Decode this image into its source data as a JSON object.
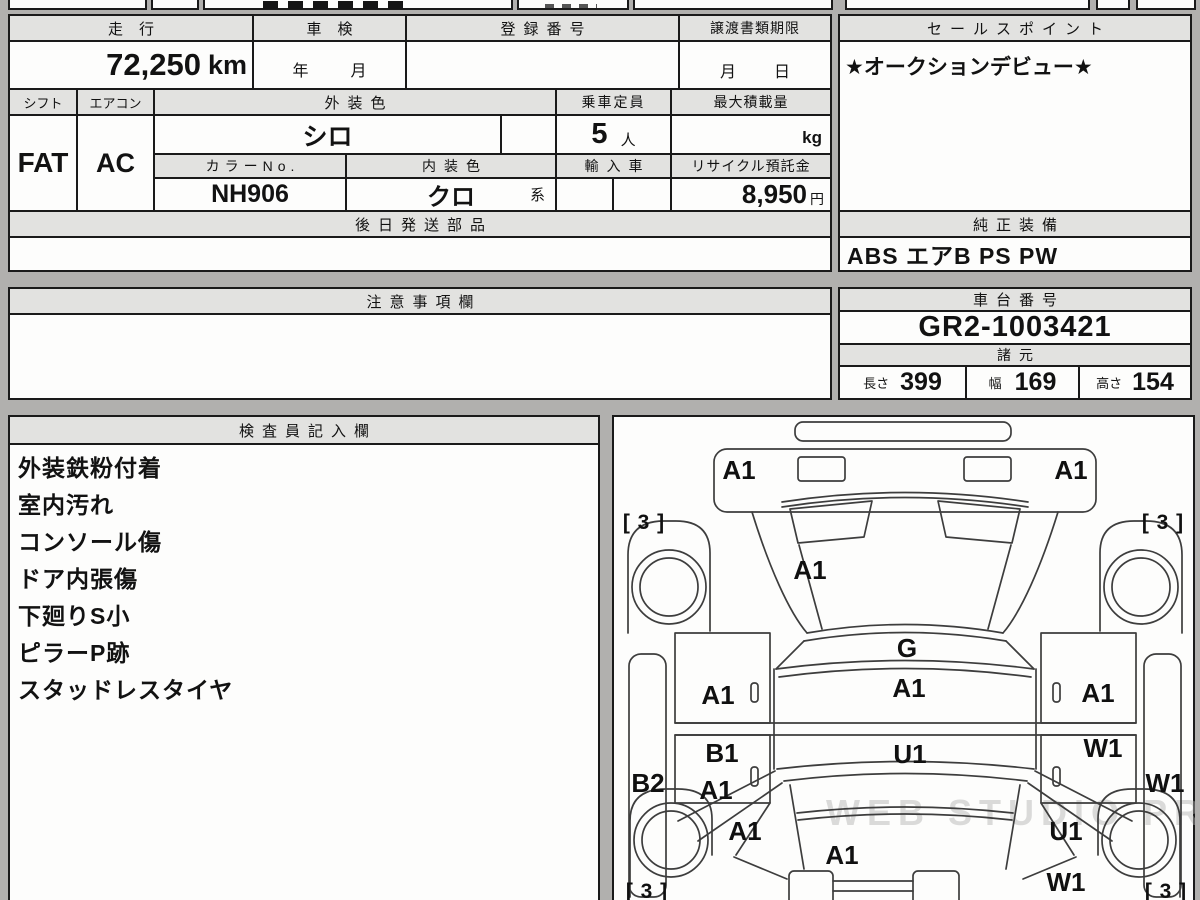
{
  "top": {
    "mileage_label": "走行",
    "mileage_value": "72,250",
    "mileage_unit": "km",
    "shaken_label": "車検",
    "shaken_year": "年",
    "shaken_month": "月",
    "regno_label": "登録番号",
    "transfer_label": "譲渡書類期限",
    "transfer_month": "月",
    "transfer_day": "日"
  },
  "sales": {
    "label": "セールスポイント",
    "value": "★オークションデビュー★"
  },
  "spec": {
    "shift_label": "シフト",
    "shift_value": "FAT",
    "aircon_label": "エアコン",
    "aircon_value": "AC",
    "ext_color_label": "外装色",
    "ext_color_value": "シロ",
    "capacity_label": "乗車定員",
    "capacity_value": "5",
    "capacity_unit": "人",
    "max_load_label": "最大積載量",
    "max_load_unit": "kg",
    "color_no_label": "カラーNo.",
    "color_no_value": "NH906",
    "int_color_label": "内装色",
    "int_color_value": "クロ",
    "int_color_suffix": "系",
    "import_label": "輸入車",
    "recycle_label": "リサイクル預託金",
    "recycle_value": "8,950",
    "recycle_unit": "円"
  },
  "parts": {
    "label": "後日発送部品"
  },
  "equipment": {
    "label": "純正装備",
    "value": "ABS エアB PS PW"
  },
  "notes": {
    "label": "注意事項欄"
  },
  "chassis": {
    "label": "車台番号",
    "value": "GR2-1003421"
  },
  "dimensions": {
    "label": "諸元",
    "length_label": "長さ",
    "length_value": "399",
    "width_label": "幅",
    "width_value": "169",
    "height_label": "高さ",
    "height_value": "154"
  },
  "inspector": {
    "label": "検査員記入欄",
    "notes": [
      "外装鉄粉付着",
      "室内汚れ",
      "コンソール傷",
      "ドア内張傷",
      "下廻りS小",
      "ピラーP跡",
      "スタッドレスタイヤ"
    ]
  },
  "diagram": {
    "watermark": "WEB STUDIO PRO",
    "marks": [
      {
        "text": "A1",
        "x": 125,
        "y": 62
      },
      {
        "text": "A1",
        "x": 457,
        "y": 62
      },
      {
        "text": "[ 3 ]",
        "x": 30,
        "y": 112
      },
      {
        "text": "[ 3 ]",
        "x": 549,
        "y": 112
      },
      {
        "text": "A1",
        "x": 196,
        "y": 162
      },
      {
        "text": "G",
        "x": 293,
        "y": 240
      },
      {
        "text": "A1",
        "x": 104,
        "y": 287
      },
      {
        "text": "A1",
        "x": 295,
        "y": 280
      },
      {
        "text": "A1",
        "x": 484,
        "y": 285
      },
      {
        "text": "B1",
        "x": 108,
        "y": 345
      },
      {
        "text": "U1",
        "x": 296,
        "y": 346
      },
      {
        "text": "W1",
        "x": 489,
        "y": 340
      },
      {
        "text": "B2",
        "x": 34,
        "y": 375
      },
      {
        "text": "A1",
        "x": 102,
        "y": 382
      },
      {
        "text": "W1",
        "x": 551,
        "y": 375
      },
      {
        "text": "A1",
        "x": 131,
        "y": 423
      },
      {
        "text": "U1",
        "x": 452,
        "y": 423
      },
      {
        "text": "A1",
        "x": 228,
        "y": 447
      },
      {
        "text": "W1",
        "x": 452,
        "y": 474
      },
      {
        "text": "[ 3 ]",
        "x": 33,
        "y": 481
      },
      {
        "text": "[ 3 ]",
        "x": 552,
        "y": 481
      }
    ]
  }
}
